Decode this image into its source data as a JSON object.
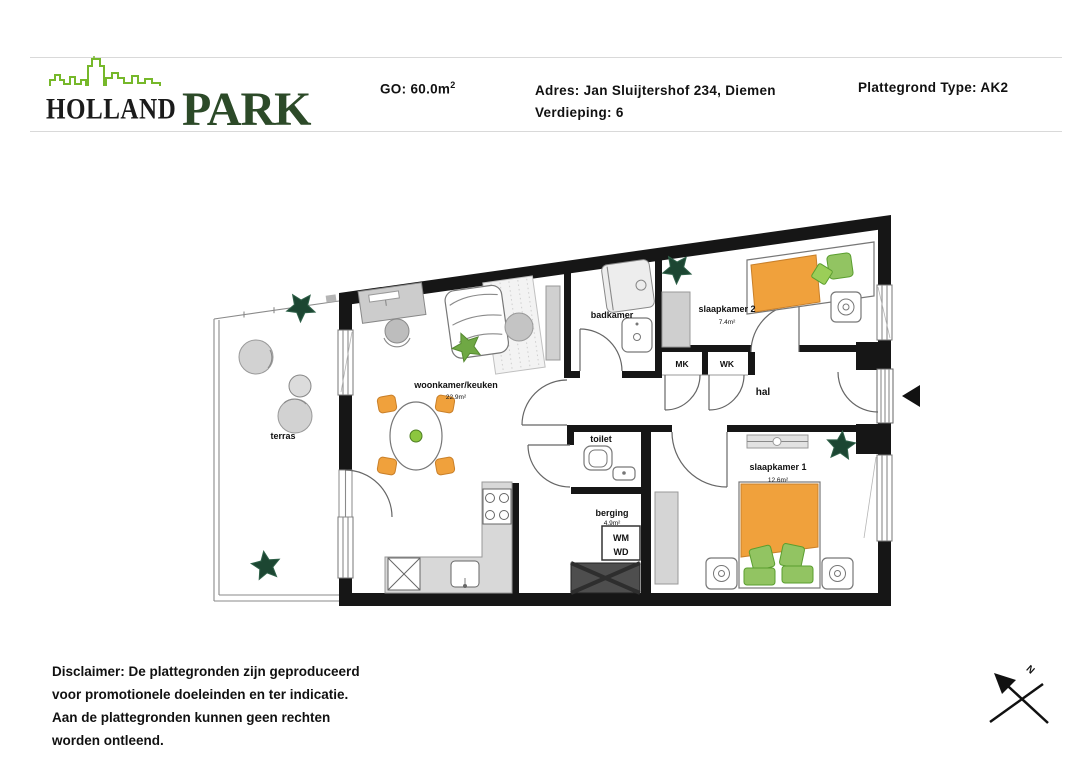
{
  "header": {
    "logo": {
      "word1": "HOLLAND",
      "word2": "PARK"
    },
    "go_label": "GO: 60.0m",
    "go_sup": "2",
    "adres": "Adres: Jan Sluijtershof 234, Diemen",
    "verdieping": "Verdieping: 6",
    "plattegrond_type": "Plattegrond Type: AK2"
  },
  "floorplan": {
    "rooms": {
      "terras": {
        "label": "terras"
      },
      "woonkamer": {
        "label": "woonkamer/keuken",
        "area": "22.9m²"
      },
      "badkamer": {
        "label": "badkamer"
      },
      "slaapkamer2": {
        "label": "slaapkamer 2",
        "area": "7.4m²"
      },
      "mk": {
        "label": "MK"
      },
      "wk": {
        "label": "WK"
      },
      "hal": {
        "label": "hal"
      },
      "toilet": {
        "label": "toilet"
      },
      "berging": {
        "label": "berging",
        "area": "4.9m²"
      },
      "slaapkamer1": {
        "label": "slaapkamer 1",
        "area": "12.6m²"
      },
      "wasmachine": {
        "line1": "WM",
        "line2": "WD"
      }
    },
    "compass_label": "N"
  },
  "disclaimer": {
    "lines": [
      "Disclaimer: De plattegronden zijn geproduceerd",
      "voor promotionele doeleinden en ter indicatie.",
      "Aan de plattegronden kunnen geen rechten",
      "worden ontleend."
    ]
  },
  "colors": {
    "logo_green": "#76b82a",
    "logo_park_green": "#2c4a28",
    "wall_black": "#161616",
    "furniture_orange": "#f0a13c",
    "furniture_green": "#92c462",
    "plant_dark_green": "#1c4632",
    "counter_gray": "#d8d8d8",
    "shaft_gray": "#4e4e4e"
  }
}
